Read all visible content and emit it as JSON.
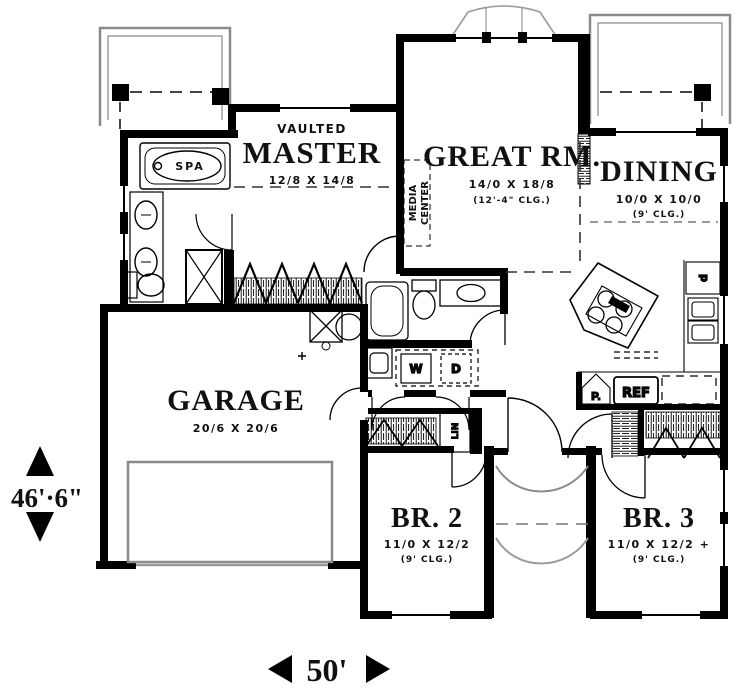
{
  "plan": {
    "rooms": {
      "master": {
        "tag": "VAULTED",
        "name": "MASTER",
        "dims": "12/8 X 14/8"
      },
      "great": {
        "name": "GREAT RM.",
        "dims": "14/0 X 18/8",
        "clg": "(12'-4\" CLG.)"
      },
      "dining": {
        "name": "DINING",
        "dims": "10/0 X 10/0",
        "clg": "(9' CLG.)"
      },
      "garage": {
        "name": "GARAGE",
        "dims": "20/6 X 20/6"
      },
      "br2": {
        "name": "BR. 2",
        "dims": "11/0 X 12/2",
        "clg": "(9' CLG.)"
      },
      "br3": {
        "name": "BR. 3",
        "dims": "11/0 X 12/2 +",
        "clg": "(9' CLG.)"
      }
    },
    "fixtures": {
      "spa": "SPA",
      "media_line1": "MEDIA",
      "media_line2": "CENTER",
      "washer": "W",
      "dryer": "D",
      "linen": "LIN",
      "pantry": "P.",
      "refrigerator": "REF",
      "dishwasher": "d"
    },
    "dimensions": {
      "width": "50'",
      "height": "46'·6\""
    },
    "colors": {
      "wall": "#000000",
      "outline": "#8a8a8a",
      "background": "#ffffff"
    }
  }
}
